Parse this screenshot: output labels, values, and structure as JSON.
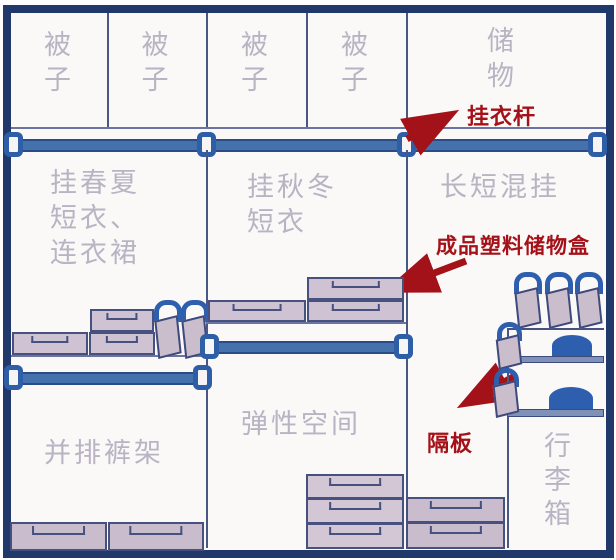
{
  "top_row": {
    "quilt_labels": [
      "被\n子",
      "被\n子",
      "被\n子",
      "被\n子"
    ],
    "storage_label": "储\n物"
  },
  "sections": {
    "left_hang": "挂春夏\n短衣、\n连衣裙",
    "center_hang": "挂秋冬\n短衣",
    "right_hang": "长短混挂",
    "pants_rack": "并排裤架",
    "flexible_space": "弹性空间",
    "luggage": "行\n李\n箱"
  },
  "annotations": {
    "hanging_rod": "挂衣杆",
    "plastic_box": "成品塑料储物盒",
    "divider_shelf": "隔板"
  },
  "colors": {
    "frame_navy": "#21386b",
    "rod_blue": "#4571ad",
    "bracket_blue": "#2e5ea6",
    "label_gray": "#b8b4c3",
    "annotation_red": "#a31218",
    "box_fill": "#cfc2d2",
    "drawer_fill": "#c9bccd",
    "accent_blue": "#2d5fae",
    "shelf_board": "#8091b8"
  }
}
